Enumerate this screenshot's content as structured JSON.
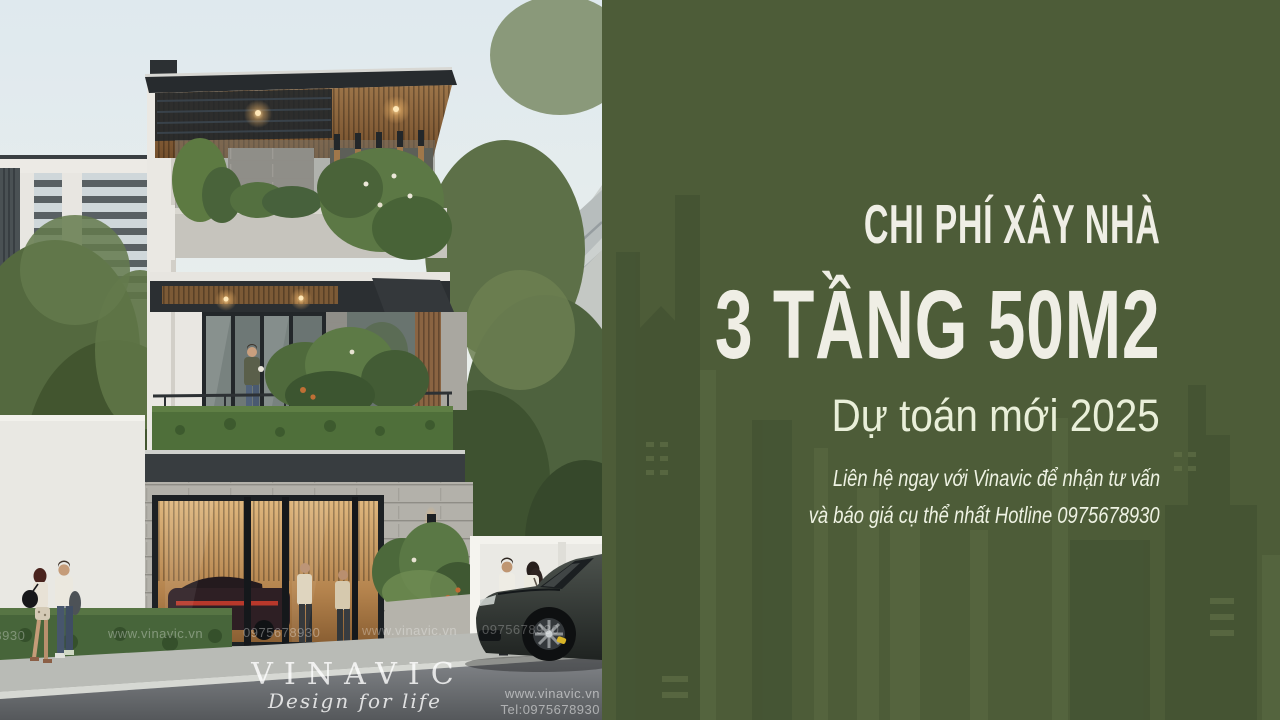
{
  "panel": {
    "background_color": "#4d5c38",
    "text_color": "#efeee5",
    "kicker": "CHI PHÍ XÂY NHÀ",
    "title": "3 TẦNG 50M2",
    "subtitle": "Dự toán mới 2025",
    "note_line1": "Liên hệ ngay với Vinavic để nhận tư vấn",
    "note_line2": "và báo giá cụ thể nhất Hotline 0975678930"
  },
  "photo": {
    "watermarks": {
      "row": [
        "0975678930",
        "www.vinavic.vn",
        "0975678930",
        "www.vinavic.vn",
        "0975678930"
      ],
      "brand": "VINAVIC",
      "brand_tagline": "Design for life",
      "corner_site": "www.vinavic.vn",
      "corner_tel": "Tel:0975678930"
    }
  }
}
